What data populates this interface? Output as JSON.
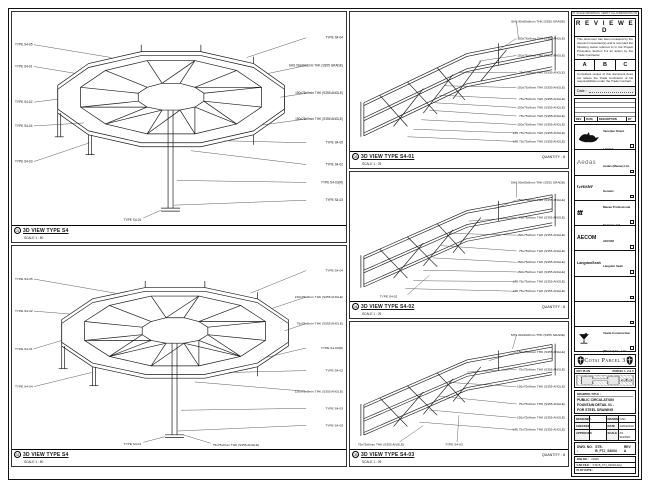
{
  "sheet": {
    "edge_note": "DO NOT SCALE DRAWINGS. VERIFY ALL DIMENSIONS ON SITE."
  },
  "views": {
    "v1": {
      "ref": "01",
      "title": "3D VIEW TYPE S4",
      "scale": "SCALE 1 : 50",
      "left": [
        "TYPE S4-05",
        "TYPE S4-01",
        "TYPE S4-02",
        "TYPE S4-04",
        "TYPE S4-03"
      ],
      "right": [
        "TYPE S4-04",
        "SHS 90x90x8mm THK (S355 GRADE)",
        "150x75x9mm THK (S355 ANGLE)",
        "150x75x9mm THK (S355 ANGLE)",
        "TYPE S4-05",
        "TYPE S4-02",
        "TYPE S4-03(R)",
        "TYPE S4-03"
      ],
      "bottom": [
        "TYPE S4-01"
      ]
    },
    "v2": {
      "ref": "02",
      "title": "3D VIEW TYPE S4",
      "scale": "SCALE 1 : 50",
      "left": [
        "TYPE S4-05",
        "TYPE S4-02",
        "TYPE S4-01",
        "TYPE S4-04"
      ],
      "right": [
        "TYPE S4-04",
        "150x75x9mm THK (S355 ANGLE)",
        "75x75x6mm THK (S355 ANGLE)",
        "TYPE S4-03(R)",
        "TYPE S4-02",
        "150x75x9mm THK (S355 ANGLE)",
        "TYPE S4-03",
        "TYPE S4-05"
      ],
      "bottom": [
        "TYPE S4-01",
        "75x75x6mm THK (S355 ANGLE)"
      ]
    },
    "v3": {
      "ref": "03",
      "title": "3D VIEW TYPE S4-01",
      "scale": "SCALE 1 : 25",
      "quantity": "QUANTITY : 8",
      "callouts": [
        "SHS 90x90x8mm THK (S355 GRADE)",
        "150x75x9mm THK (S355 ANGLE)",
        "150x75x9mm THK (S355 ANGLE)",
        "75x75x6mm THK (S355 ANGLE)",
        "150x75x9mm THK (S355 ANGLE)",
        "75x75x6mm THK (S355 ANGLE)",
        "150x75x9mm THK (S355 ANGLE)",
        "75x75x6mm THK (S355 ANGLE)",
        "150x75x9mm THK (S355 ANGLE)",
        "L75 75x75x6mm THK (S355 ANGLE)",
        "L75 75x75x6mm THK (S355 ANGLE)"
      ]
    },
    "v4": {
      "ref": "04",
      "title": "3D VIEW TYPE S4-02",
      "scale": "SCALE 1 : 25",
      "quantity": "QUANTITY : 8",
      "callouts": [
        "SHS 90x90x8mm THK (S355 GRADE)",
        "150x75x9mm THK (S355 ANGLE)",
        "75x75x6mm THK (S355 ANGLE)",
        "150x75x9mm THK (S355 ANGLE)",
        "75x75x6mm THK (S355 ANGLE)",
        "150x75x9mm THK (S355 ANGLE)",
        "150x75x9mm THK (S355 ANGLE)",
        "L75 75x75x6mm THK (S355 ANGLE)",
        "L75 75x75x6mm THK (S355 ANGLE)"
      ],
      "bottom": [
        "TYPE S4-02"
      ]
    },
    "v5": {
      "ref": "05",
      "title": "3D VIEW TYPE S4-03",
      "scale": "SCALE 1 : 25",
      "quantity": "QUANTITY : 8",
      "callouts": [
        "SHS 90x90x8mm THK (S355 GRADE)",
        "150x75x9mm THK (S355 ANGLE)",
        "75x75x6mm THK (S355 ANGLE)",
        "150x75x9mm THK (S355 ANGLE)",
        "75x75x6mm THK (S355 ANGLE)",
        "150x75x9mm THK (S355 ANGLE)",
        "L75 75x75x6mm THK (S355 ANGLE)"
      ],
      "bottom": [
        "75x75x6mm THK (S355 ANGLE)",
        "TYPE S4-03"
      ]
    }
  },
  "stamp": {
    "title": "R E V I E W E D",
    "para1": "This document has been reviewed by the relevant Consultant(s) and is recorded the following status referred to in the Project Procedure Section 5.4 for action by the Trade Contractor.",
    "options": {
      "a": "A",
      "b": "B",
      "c": "C"
    },
    "para2": "Consultant review of this document does not relieve the Trade Contractor of his responsibilities under the Trade Contract.",
    "date_label": "Date :"
  },
  "revision": {
    "headers": [
      "REV",
      "DATE",
      "DESCRIPTION",
      "BY"
    ]
  },
  "parties": [
    {
      "name": "Venetian Orient Limited"
    },
    {
      "logo": "Aedas",
      "name": "Aedas (Macau) Ltd."
    },
    {
      "logo": "Gensler",
      "name": "Gensler"
    },
    {
      "logo": "ttt",
      "name": "Macau Professional Services Ltd."
    },
    {
      "logo": "AECOM",
      "name": "AECOM"
    },
    {
      "logo": "LangdonSeah",
      "name": "Langdon Seah"
    },
    {
      "name": ""
    },
    {
      "name": ""
    },
    {
      "name": "Yeade Construction (Macau) Co., Ltd."
    }
  ],
  "project": {
    "banner": "Cotai Parcel 3"
  },
  "keyplan": {
    "label": "KEY PLAN",
    "parcel": "PARCEL 1, 2 & 3"
  },
  "titleblock": {
    "drawing_title_label": "DRAWING TITLE :",
    "title_line1": "PUBLIC CIRCULATION",
    "title_line2": "FOUNTAIN DETAIL 01 -",
    "title_line3": "FOR STEEL DRAWING",
    "designed_label": "DESIGNED",
    "designed_value": "-",
    "drawn_label": "DRAWN",
    "drawn_value": "CAD",
    "checked_label": "CHECKED",
    "checked_value": "-",
    "date_label": "DATE",
    "date_value": "14/04/2010",
    "approved_label": "APPROVED",
    "approved_value": "-",
    "scale_label": "SCALE",
    "scale_value": "AS SHOWN",
    "dwg_label": "DWG. NO. :",
    "dwg_value": "STE-B_FTJ_S4004",
    "rev_label": "REV",
    "rev_value": "A",
    "job_label": "JOB NO. :",
    "job_value": "21026",
    "cad_label": "CAD FILE :",
    "cad_value": "STE-B_FTJ_S4004.dwg",
    "plot_label": "PLOT DATE :",
    "plot_value": ""
  }
}
